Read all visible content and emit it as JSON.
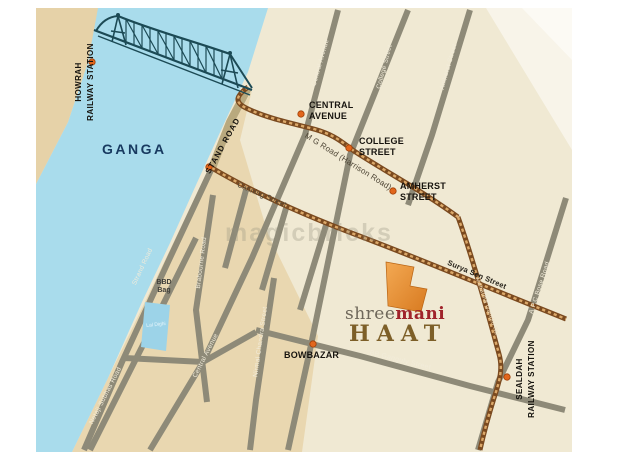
{
  "watermark": "magicbricks",
  "river": {
    "name": "GANGA"
  },
  "stations": {
    "howrah": {
      "line1": "HOWRAH",
      "line2": "RAILWAY STATION"
    },
    "sealdah": {
      "line1": "SEALDAH",
      "line2": "RAILWAY STATION"
    }
  },
  "landmarks": {
    "central_avenue": {
      "line1": "CENTRAL",
      "line2": "AVENUE"
    },
    "college_street": {
      "line1": "COLLEGE",
      "line2": "STREET"
    },
    "amherst_street": {
      "line1": "AMHERST",
      "line2": "STREET"
    },
    "bowbazar": "BOWBAZAR",
    "stand_road": "STAND ROAD",
    "bbd_bag": {
      "line1": "BBD",
      "line2": "Bag"
    },
    "lal_dighi": "Lal Dighi"
  },
  "streets": {
    "mg_road": "M G Road (Harrison Road)",
    "canning": "Canning Street",
    "surya_sen": "Surya Sen Street",
    "bb_ganguly": "BB Ganguly Street",
    "central_avenue": "Central Avenue",
    "college_street": "College Street",
    "amherst_street": "Amherst Street",
    "apc_bose": "A.P.C Bose Road",
    "strand": "Strand Road",
    "netaji_subhas": "Netaji Subhas Road",
    "brabourne": "Brabourne Road",
    "nirmal_chandra": "Nirmal Chandra Street",
    "mahatma_gandhi": "Mahatma Gandhi Rd"
  },
  "logo": {
    "shree": "shree",
    "mani": "mani",
    "haat": "HAAT"
  },
  "colors": {
    "river": "#a9dcec",
    "land": "#f0e9d3",
    "land_tan": "#e9d7b0",
    "road_gray": "#8e8a78",
    "route_brown": "#7b4a1f",
    "route_dash": "#dca96a",
    "marker_orange": "#e2661c",
    "bridge_teal": "#1c4a55",
    "logo_brown": "#7d5f28",
    "logo_red": "#a0232b"
  }
}
